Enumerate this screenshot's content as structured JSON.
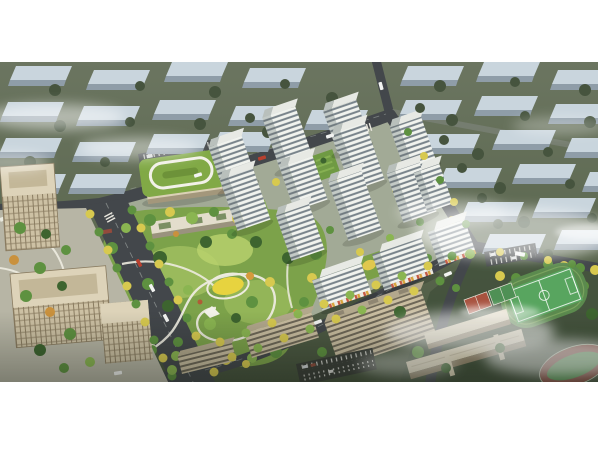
{
  "meta": {
    "type": "aerial-architectural-rendering",
    "subject": "bird's-eye masterplan rendering of a residential development with central landscaped park, white high-rise towers, kindergarten, office buildings, school campus with sports field, surrounded by desaturated context city blocks and fog",
    "visible_text": "none"
  },
  "palette": {
    "ground-far": "#67725c",
    "ground-near": "#4a573f",
    "site-ground": "#a2aa96",
    "context-roof": "#c9d5dd",
    "context-side": "#8f9da8",
    "context-tree": "#46543e",
    "road-dark": "#43474b",
    "road-light": "#7b8277",
    "tower-face": "#f1f3ee",
    "tower-side": "#c3cac6",
    "tower-window": "#5a6770",
    "tower-roof": "#e7e9e4",
    "tower-roof-dark": "#b9c0bc",
    "park-base": "#7ca24a",
    "park-light": "#9dbd5e",
    "park-bright": "#bad36e",
    "tree-dark": "#3d642f",
    "tree-green": "#5e9140",
    "tree-light": "#8ab551",
    "tree-yellow": "#d7c94f",
    "tree-orange": "#c9913d",
    "tree-red": "#b05c36",
    "path-white": "#edebdf",
    "kinder-roof": "#81a946",
    "kinder-body": "#dbd1b6",
    "office-beige": "#cdc1a4",
    "office-roof": "#ddd3b9",
    "school-roof": "#d6ccb0",
    "school-side": "#8f8268",
    "court-red": "#a8523f",
    "court-green": "#4f9055",
    "field-green": "#58a55f",
    "track-red": "#7e473c",
    "playground-yellow": "#e7d33f"
  },
  "scene": {
    "regions": [
      {
        "name": "context-blocks",
        "description": "rows of faded blue-grey slab buildings on muted green ground, top and right"
      },
      {
        "name": "residential-towers",
        "description": "cluster of white mid/high-rise towers with horizontal window bands, about 14 buildings"
      },
      {
        "name": "central-park",
        "description": "large organic green park with winding white paths, yellow playground, dense trees"
      },
      {
        "name": "kindergarten",
        "description": "low beige building with green roof and white loop path"
      },
      {
        "name": "boulevard",
        "description": "wide avenue lined with yellow and green trees, lower left"
      },
      {
        "name": "office-complex",
        "description": "beige grid-facade office blocks with plaza, bottom left"
      },
      {
        "name": "school-campus",
        "description": "long beige school slabs, basketball courts, green sports field, red track, bottom right"
      },
      {
        "name": "fog",
        "description": "soft white cloud wisps over top-left, right-center and bottom-right"
      }
    ],
    "counts": {
      "residential_buildings": 14,
      "context_slabs": 31
    }
  }
}
